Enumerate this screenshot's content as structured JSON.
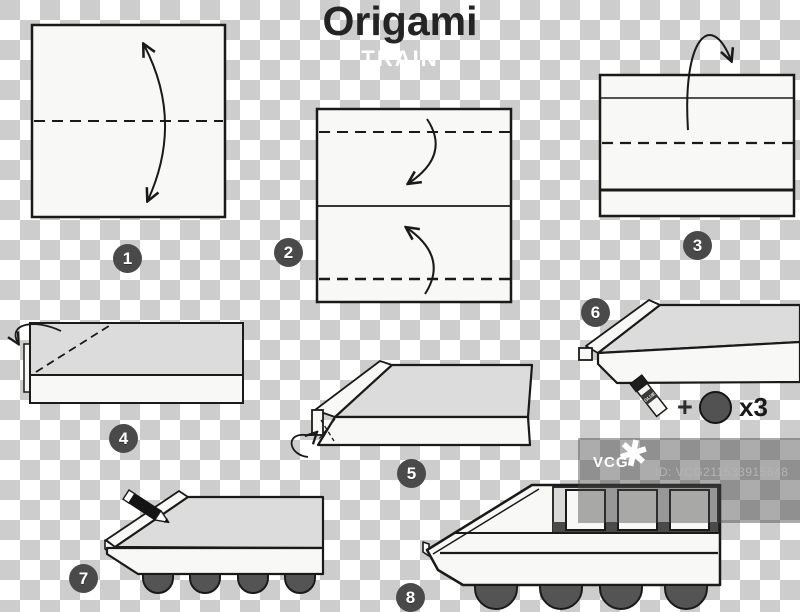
{
  "title": "Origami",
  "subtitle": "TRAIN",
  "steps": [
    {
      "number": "1"
    },
    {
      "number": "2"
    },
    {
      "number": "3"
    },
    {
      "number": "4"
    },
    {
      "number": "5"
    },
    {
      "number": "6"
    },
    {
      "number": "7"
    },
    {
      "number": "8"
    }
  ],
  "materials": {
    "glue_label": "GLUE",
    "plus_sign": "+",
    "quantity": "x3"
  },
  "watermark": {
    "brand": "VCG",
    "star_icon": "✱",
    "id_text": "ID: VCG211533915648"
  },
  "colors": {
    "checker_gray": "#cdcdcd",
    "paper_white": "#f8f8f6",
    "paper_shade": "#dcdcdc",
    "outline": "#1a1a1a",
    "badge_bg": "#4a4a4a",
    "wheel_fill": "#545454",
    "sill_dark": "#4a4a4a"
  }
}
